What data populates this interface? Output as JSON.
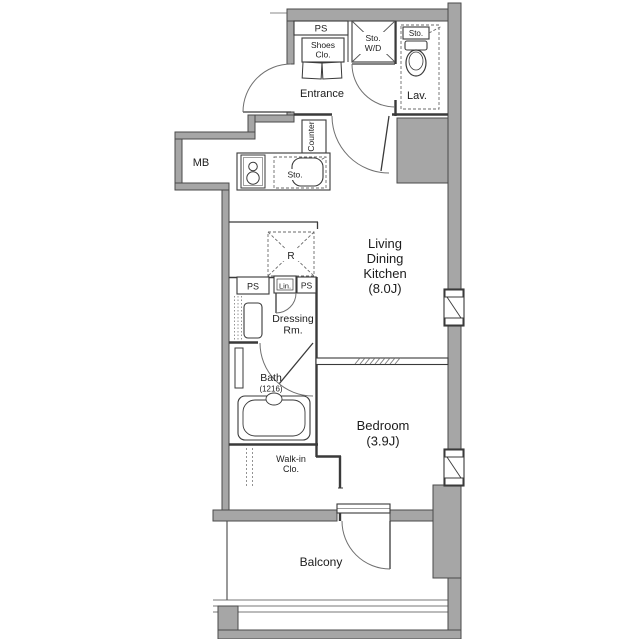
{
  "meta": {
    "drawing_type": "apartment floor plan"
  },
  "colors": {
    "background": "#ffffff",
    "wall_fill": "#a6a6a6",
    "wall_edge": "#4a4a4a",
    "interior_line": "#3a3a3a",
    "dashed_line": "#6a6a6a",
    "text": "#1c1c1c"
  },
  "rooms": {
    "entrance": {
      "label": "Entrance"
    },
    "lavatory": {
      "label": "Lav."
    },
    "living_dining_kitchen": {
      "label_lines": [
        "Living",
        "Dining",
        "Kitchen"
      ],
      "area": "(8.0J)"
    },
    "dressing_room": {
      "label_lines": [
        "Dressing",
        "Rm."
      ]
    },
    "bath": {
      "label": "Bath",
      "module": "(1216)"
    },
    "bedroom": {
      "label": "Bedroom",
      "area": "(3.9J)"
    },
    "walk_in_closet": {
      "label_lines": [
        "Walk-in",
        "Clo."
      ]
    },
    "balcony": {
      "label": "Balcony"
    }
  },
  "fixtures": {
    "meter_box": "MB",
    "pipe_space_top": "PS",
    "shoes_closet_lines": [
      "Shoes",
      "Clo."
    ],
    "storage_washer_dryer_lines": [
      "Sto.",
      "W/D"
    ],
    "storage_lavatory": "Sto.",
    "kitchen_counter": "Counter",
    "storage_kitchen": "Sto.",
    "refrigerator": "R",
    "pipe_space_left": "PS",
    "linen_closet": "Lin.",
    "pipe_space_mid": "PS"
  }
}
